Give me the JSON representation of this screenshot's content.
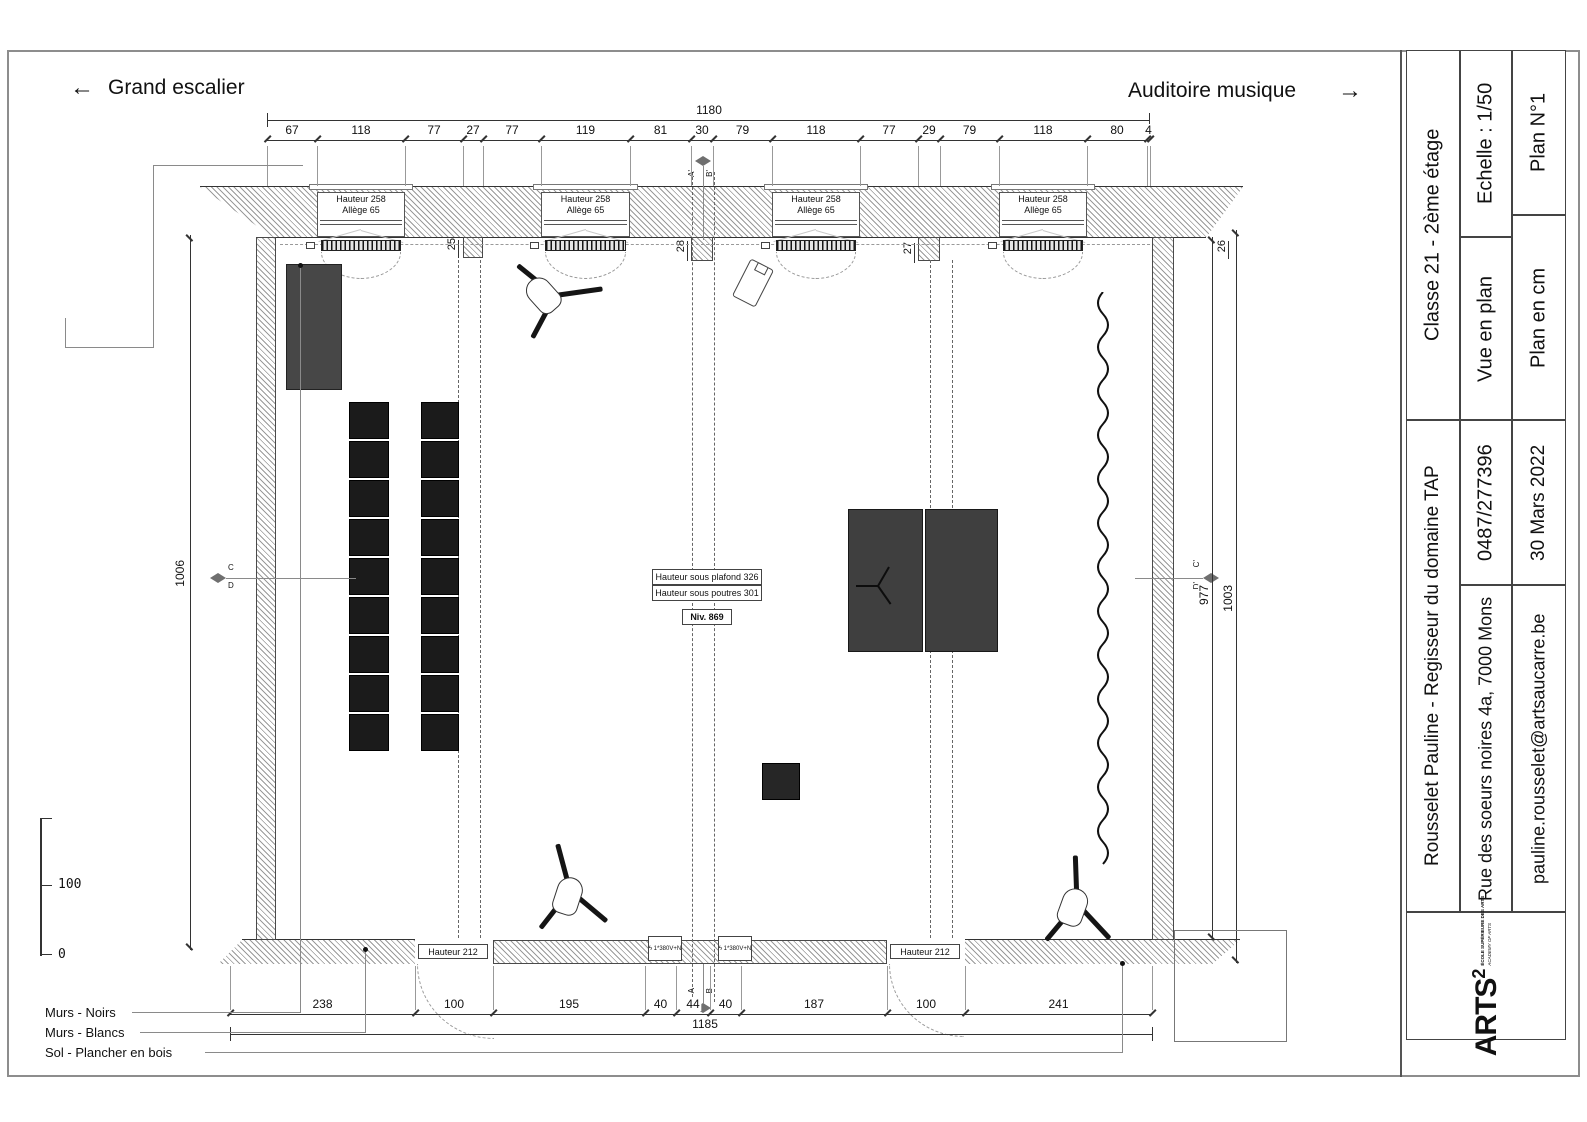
{
  "header": {
    "left_arrow": "←",
    "left_label": "Grand escalier",
    "right_label": "Auditoire musique",
    "right_arrow": "→"
  },
  "plan": {
    "window_label_1": "Hauteur 258",
    "window_label_2": "Allège 65",
    "door_label": "Hauteur 212",
    "ceiling_note": "Hauteur sous plafond 326",
    "beam_note": "Hauteur sous poutres 301",
    "level_note": "Niv. 869",
    "outlet_label": "ϟ 1*380V+N"
  },
  "dims": {
    "top_total": "1180",
    "top_segments": [
      "67",
      "118",
      "77",
      "27",
      "77",
      "119",
      "81",
      "30",
      "79",
      "118",
      "77",
      "29",
      "79",
      "118",
      "80",
      "4"
    ],
    "bottom_total": "1185",
    "bottom_segments": [
      "238",
      "100",
      "195",
      "40",
      "44",
      "40",
      "187",
      "100",
      "241"
    ],
    "left_height": "1006",
    "right_inner": "977",
    "right_outer": "1003",
    "pillar_dims": [
      "25",
      "28",
      "27",
      "26"
    ]
  },
  "markers": {
    "top": [
      "A'",
      "B'"
    ],
    "bottom": [
      "A",
      "B"
    ],
    "left": [
      "C",
      "D"
    ],
    "right": [
      "C'",
      "D'"
    ]
  },
  "legend": {
    "wall_black": "Murs - Noirs",
    "wall_white": "Murs - Blancs",
    "floor": "Sol - Plancher en bois",
    "scale_100": "100",
    "scale_0": "0"
  },
  "title_block": {
    "project": "Rousselet Pauline - Regisseur du domaine TAP",
    "room": "Classe 21 - 2ème étage",
    "address": "Rue des soeurs noires 4a, 7000 Mons",
    "phone": "0487/277396",
    "view": "Vue en plan",
    "scale": "Echelle : 1/50",
    "email": "pauline.rousselet@artsaucarre.be",
    "date": "30 Mars 2022",
    "units": "Plan en cm",
    "plan_number": "Plan N°1",
    "logo_name": "ARTS",
    "logo_sup": "2",
    "logo_line1": "ÉCOLE SUPÉRIEURE DES ARTS",
    "logo_line2": "ACADEMY OF ARTS"
  },
  "colors": {
    "line": "#333333",
    "hatch": "#9a9a9a",
    "furniture_dark": "#1b1b1b",
    "cabinet_grey": "#474747",
    "piano_grey": "#3f3f3f",
    "marker_fill": "#6f6f6f"
  }
}
